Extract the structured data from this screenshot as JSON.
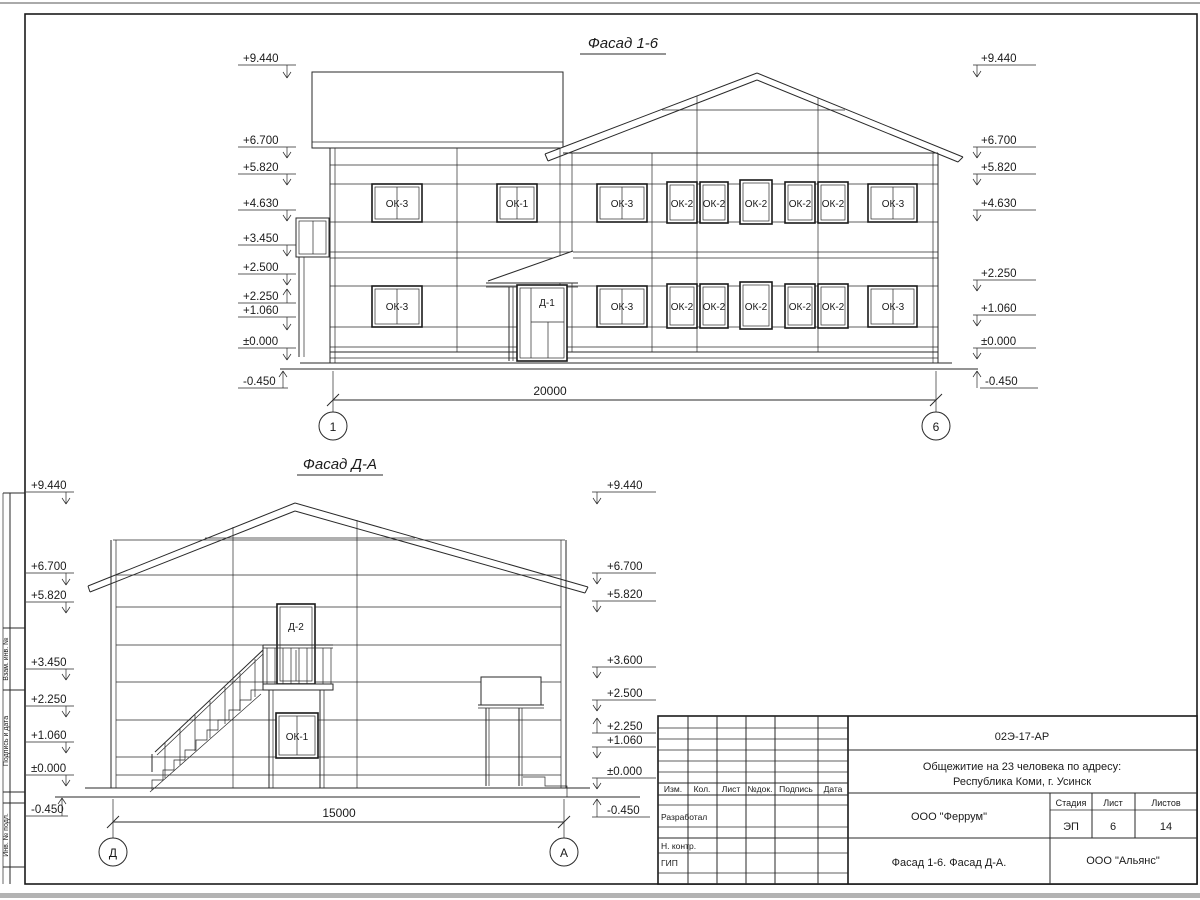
{
  "facade16": {
    "title": "Фасад 1-6",
    "left_marks": [
      "+9.440",
      "+6.700",
      "+5.820",
      "+4.630",
      "+3.450",
      "+2.500",
      "+2.250",
      "+1.060",
      "±0.000",
      "-0.450"
    ],
    "right_marks": [
      "+9.440",
      "+6.700",
      "+5.820",
      "+4.630",
      "+2.250",
      "+1.060",
      "±0.000",
      "-0.450"
    ],
    "windows_top": [
      "ОК-3",
      "ОК-1",
      "ОК-3",
      "ОК-2",
      "ОК-2",
      "ОК-2",
      "ОК-2",
      "ОК-2",
      "ОК-3"
    ],
    "windows_bottom": [
      "ОК-3",
      "ОК-3",
      "ОК-2",
      "ОК-2",
      "ОК-2",
      "ОК-2",
      "ОК-2",
      "ОК-3"
    ],
    "door_label": "Д-1",
    "dim": "20000",
    "axis_left": "1",
    "axis_right": "6"
  },
  "facadeDA": {
    "title": "Фасад Д-А",
    "left_marks": [
      "+9.440",
      "+6.700",
      "+5.820",
      "+3.450",
      "+2.250",
      "+1.060",
      "±0.000",
      "-0.450"
    ],
    "right_marks": [
      "+9.440",
      "+6.700",
      "+5.820",
      "+3.600",
      "+2.500",
      "+2.250",
      "+1.060",
      "±0.000",
      "-0.450"
    ],
    "door_label": "Д-2",
    "window_label": "ОК-1",
    "dim": "15000",
    "axis_left": "Д",
    "axis_right": "А"
  },
  "side_stamp": {
    "c1": "Взам. инв. №",
    "c2": "Подпись и дата",
    "c3": "Инв. № подл."
  },
  "titleblock": {
    "code": "02Э-17-АР",
    "project1": "Общежитие на 23 человека по адресу:",
    "project2": "Республика Коми, г. Усинск",
    "h_izm": "Изм.",
    "h_kol": "Кол.",
    "h_list": "Лист",
    "h_ndok": "№док.",
    "h_podpis": "Подпись",
    "h_data": "Дата",
    "r_razrab": "Разработал",
    "r_nkontr": "Н. контр.",
    "r_gip": "ГИП",
    "org": "ООО \"Феррум\"",
    "stage_h": "Стадия",
    "sheet_h": "Лист",
    "sheets_h": "Листов",
    "stage": "ЭП",
    "sheet": "6",
    "sheets": "14",
    "content": "Фасад 1-6. Фасад Д-А.",
    "org2": "ООО \"Альянс\""
  }
}
